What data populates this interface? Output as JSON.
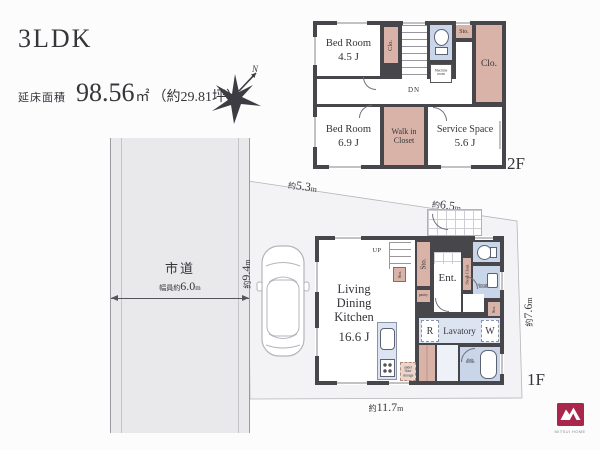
{
  "header": {
    "title": "3LDK",
    "area_label": "延床面積",
    "area_value": "98.56",
    "area_unit": "㎡",
    "area_tsubo": "（約29.81坪）",
    "north_label": "N"
  },
  "road": {
    "name": "市道",
    "width_prefix": "幅員約",
    "width_value": "6.0",
    "width_unit": "m"
  },
  "dimensions": {
    "top_left": {
      "prefix": "約",
      "value": "5.3",
      "unit": "m"
    },
    "top_right": {
      "prefix": "約",
      "value": "6.5",
      "unit": "m"
    },
    "left_side": {
      "prefix": "約",
      "value": "9.4",
      "unit": "m"
    },
    "right_side": {
      "prefix": "約",
      "value": "7.6",
      "unit": "m"
    },
    "bottom": {
      "prefix": "約",
      "value": "11.7",
      "unit": "m"
    }
  },
  "floor_2f": {
    "label": "2F",
    "bedroom_small": {
      "name": "Bed Room",
      "size": "4.5 J"
    },
    "bedroom_large": {
      "name": "Bed Room",
      "size": "6.9 J"
    },
    "service_space": {
      "name": "Service Space",
      "size": "5.6 J"
    },
    "walk_in_closet": {
      "line1": "Walk in",
      "line2": "Closet"
    },
    "closet_strip": "Clo.",
    "closet_right": "Clo.",
    "storage": "Sto.",
    "stairs_down": "DN",
    "machine_room": "Machine room"
  },
  "floor_1f": {
    "label": "1F",
    "ldk": {
      "line1": "Living",
      "line2": "Dining",
      "line3": "Kitchen",
      "size": "16.6 J"
    },
    "stairs_up": "UP",
    "entrance": "Ent.",
    "shoes_cloak": "Shoes Cloak",
    "powder_room": {
      "line1": "Powder",
      "line2": "Room"
    },
    "storage_tall": "Sto.",
    "storage_small": "Sto.",
    "storage_right": "Sto.",
    "pantry": "pantry",
    "refrigerator": "R",
    "lavatory": "Lavatory",
    "washer": "W",
    "bath_room": {
      "line1": "Bath",
      "line2": "Room"
    },
    "under_floor_storage": "under floor storage"
  },
  "logo": {
    "brand": "MITSUI HOME"
  },
  "colors": {
    "wall": "#47474b",
    "closet_pink": "#d9b3a8",
    "wet_blue": "#c9d5e8",
    "lavatory_blue": "#dde4f1",
    "road_gray": "#e9e9eb",
    "lot_gray": "#f3f3f5",
    "logo_red": "#a8274a",
    "text": "#3a3a3e"
  }
}
